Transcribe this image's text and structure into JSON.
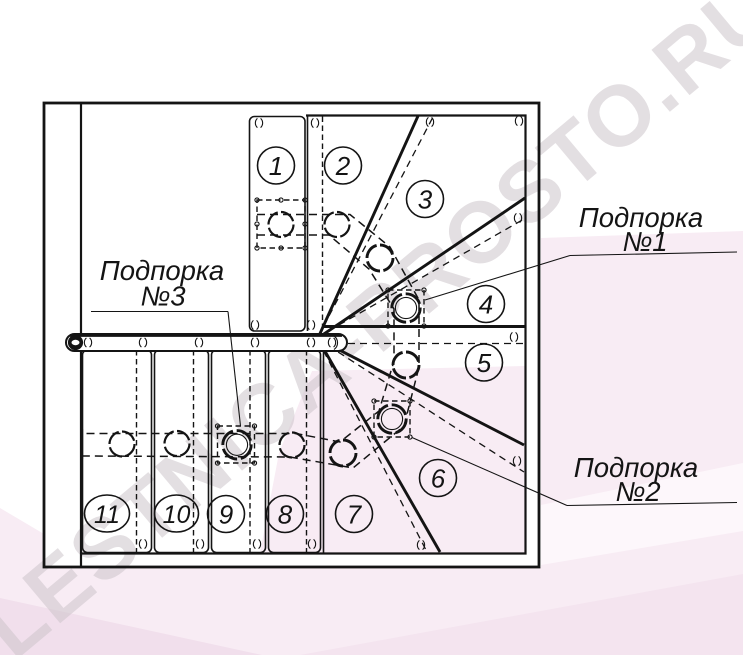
{
  "watermark": {
    "text": "LESTNICA-PROSTO.RU"
  },
  "diagram": {
    "type": "staircase-plan",
    "steps": [
      {
        "label": "1"
      },
      {
        "label": "2"
      },
      {
        "label": "3"
      },
      {
        "label": "4"
      },
      {
        "label": "5"
      },
      {
        "label": "6"
      },
      {
        "label": "7"
      },
      {
        "label": "8"
      },
      {
        "label": "9"
      },
      {
        "label": "10"
      },
      {
        "label": "11"
      }
    ],
    "supports": [
      {
        "label_lines": [
          "Подпорка",
          "№1"
        ]
      },
      {
        "label_lines": [
          "Подпорка",
          "№2"
        ]
      },
      {
        "label_lines": [
          "Подпорка",
          "№3"
        ]
      }
    ],
    "colors": {
      "line": "#141414",
      "pink": "#f8ecf4",
      "watermark": "#cdc5cb"
    }
  }
}
